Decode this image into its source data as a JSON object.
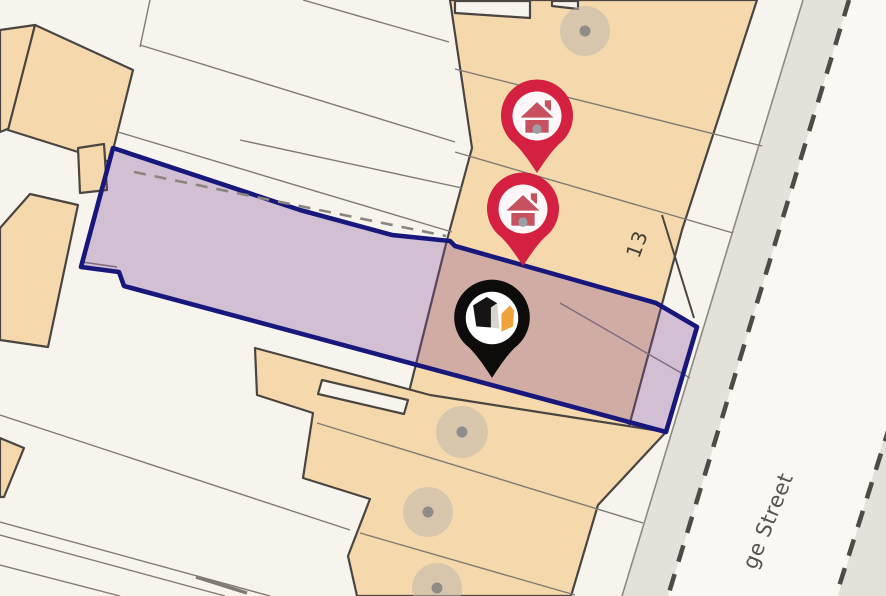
{
  "map": {
    "type": "property-location-map",
    "labels": {
      "plot_number": "13",
      "street_name": "ge Street"
    },
    "parcel": {
      "description": "highlighted property boundary",
      "outline_color": "#18177c",
      "fill_color": "rgba(125,68,150,0.30)"
    },
    "markers": {
      "house_pins": [
        {
          "id": "house-pin-1"
        },
        {
          "id": "house-pin-2"
        }
      ],
      "house_pin_color": "#d42041",
      "house_icon_color": "#c8515f",
      "house_door_color": "#9aa0a5",
      "brand_pin_color": "#0d0c0b",
      "brand_cube_color": "#171513",
      "brand_cube_face_color": "#d9d4ce",
      "brand_accent_color": "#f0a23b",
      "pin_inner_circle_color": "#ffffff"
    },
    "palette": {
      "background": "#f7f4ee",
      "building_fill": "#f5d9ad",
      "building_outline": "#4a4540",
      "boundary_line": "#7f7a74",
      "pavement_fill": "#e4e0da",
      "road_fill": "#faf8f3",
      "road_edge": "#8d8983",
      "road_dash": "#4e4a45",
      "inner_dash": "#8a857e",
      "tree_fill": "#c0b7ac",
      "tree_dot": "#8e8c88",
      "plot_label_color": "#413d38",
      "street_label_color": "#57534d"
    },
    "tree_marker_count": 4
  }
}
